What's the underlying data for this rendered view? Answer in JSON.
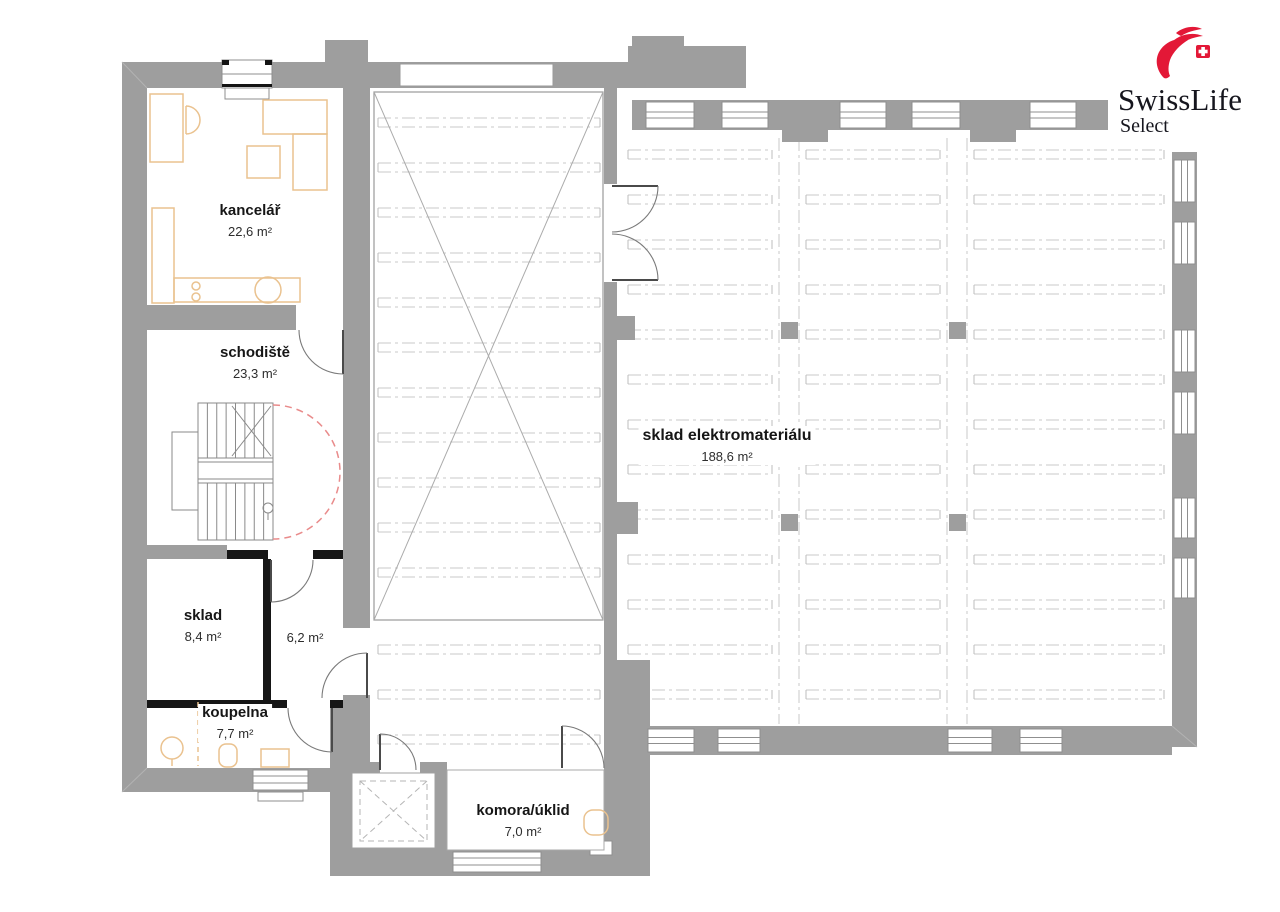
{
  "logo": {
    "brand": "SwissLife",
    "sub": "Select"
  },
  "rooms": [
    {
      "name": "kancelář",
      "area": "22,6 m²"
    },
    {
      "name": "schodiště",
      "area": "23,3 m²"
    },
    {
      "name": "sklad",
      "area": "8,4 m²"
    },
    {
      "area": "6,2 m²"
    },
    {
      "name": "koupelna",
      "area": "7,7 m²"
    },
    {
      "name": "komora/úklid",
      "area": "7,0 m²"
    },
    {
      "name": "sklad elektromateriálu",
      "area": "188,6 m²"
    }
  ],
  "colors": {
    "wall": "#9e9e9e",
    "partition": "#161616",
    "furniture": "#eac28f",
    "swing_arc": "#e98b8b",
    "grid": "#c9c9c9",
    "logo_red": "#e31837",
    "logo_text": "#16161e"
  }
}
